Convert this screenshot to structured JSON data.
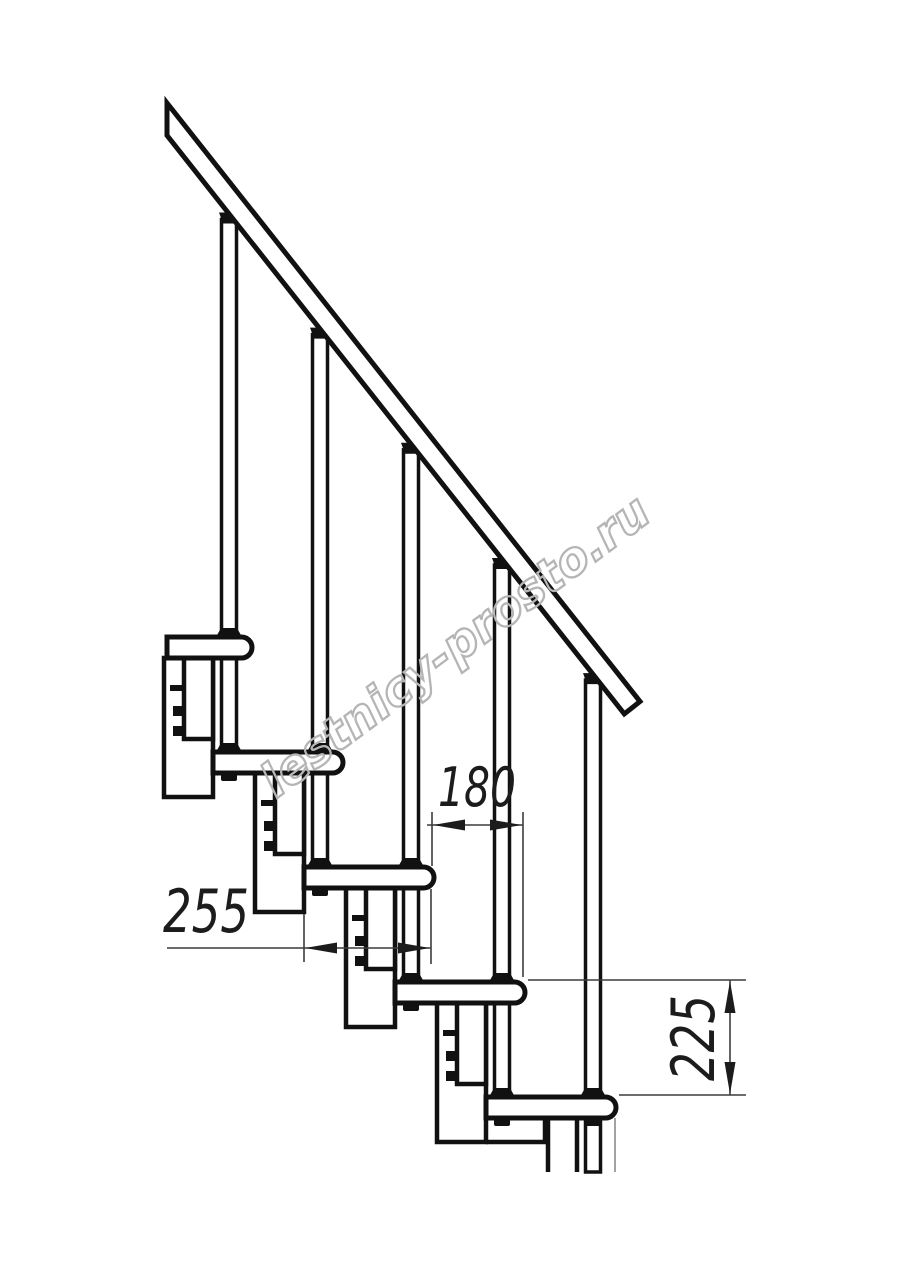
{
  "drawing": {
    "title": "modular-staircase-side-view",
    "dimensions": {
      "run": "180",
      "tread_depth": "255",
      "rise": "225"
    },
    "watermark": "lestnicy-prosto.ru",
    "colors": {
      "line": "#111111",
      "dimension_line": "#3c3c3c",
      "watermark": "#b5b5b5",
      "background": "#ffffff"
    }
  }
}
